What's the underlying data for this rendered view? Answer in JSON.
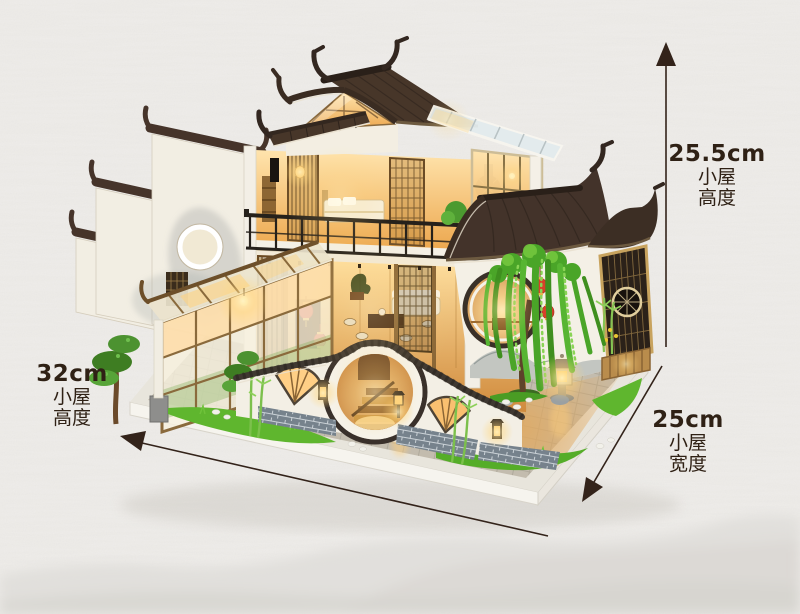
{
  "scene": {
    "description": "Product photo of a DIY miniature Chinese courtyard dollhouse with LED lighting, shown on textured paper background with faint mountain shading",
    "background_color": "#f0eeeb",
    "annotation_text_color": "#2f2115",
    "annotation_line_color": "#33231a"
  },
  "annotations": {
    "height": {
      "value": "25.5cm",
      "line1": "小屋",
      "line2": "高度"
    },
    "length": {
      "value": "32cm",
      "line1": "小屋",
      "line2": "高度"
    },
    "width": {
      "value": "25cm",
      "line1": "小屋",
      "line2": "宽度"
    }
  },
  "illustration_colors": {
    "roof_dark": "#43332a",
    "ridge_dark": "#2a2019",
    "wood": "#a87f4a",
    "wood_light": "#d9b273",
    "warm_light": "#ffd27d",
    "white_wall": "#f4f0e6",
    "glass": "#e3ecee",
    "willow_green": "#4aa528",
    "grass_green": "#5fb62e",
    "lantern_red": "#d8402a",
    "brick_gray": "#76828c",
    "paving_gray": "#c3bcae",
    "paving_warm": "#e2a95e",
    "stone_gray": "#8e8e8c"
  }
}
